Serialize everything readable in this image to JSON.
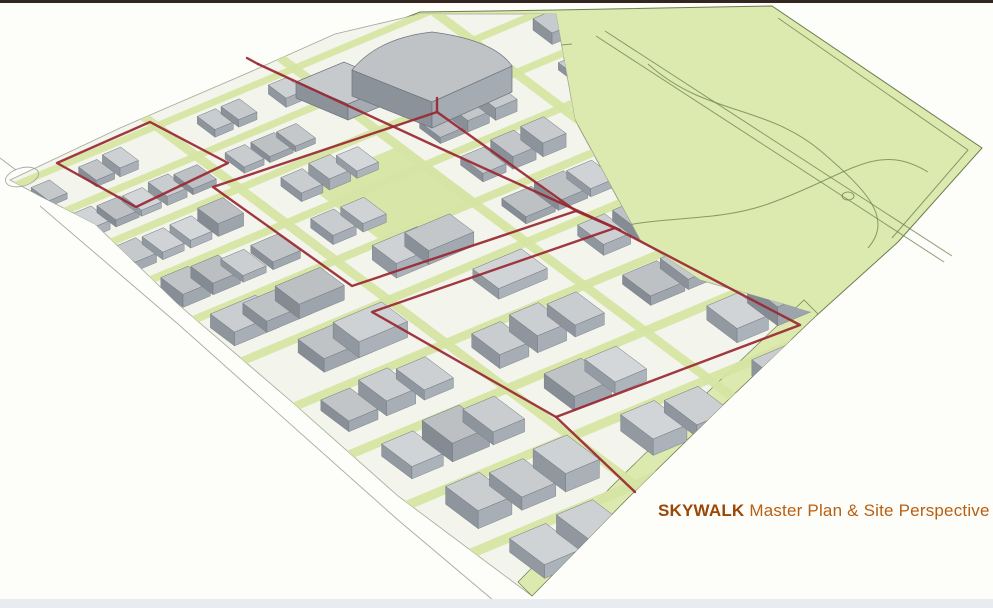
{
  "caption": {
    "brand": "SKYWALK",
    "rest": " Master Plan & Site Perspective"
  },
  "colors": {
    "background": "#fdfdf9",
    "frame_top": "#332520",
    "frame_bottom": "#e8ecf1",
    "park_green": "#dce9af",
    "park_line": "#6d7d4e",
    "street_green": "#d6e5a4",
    "ground": "#f3f4ec",
    "building_top": "#c6cacd",
    "building_side": "#8b929a",
    "building_front": "#a4abb2",
    "outline_gray": "#6e757c",
    "skywalk_red": "#992732",
    "sketch_gray": "#9b9b96",
    "caption_brand": "#9a4708",
    "caption_text": "#b85f12"
  }
}
